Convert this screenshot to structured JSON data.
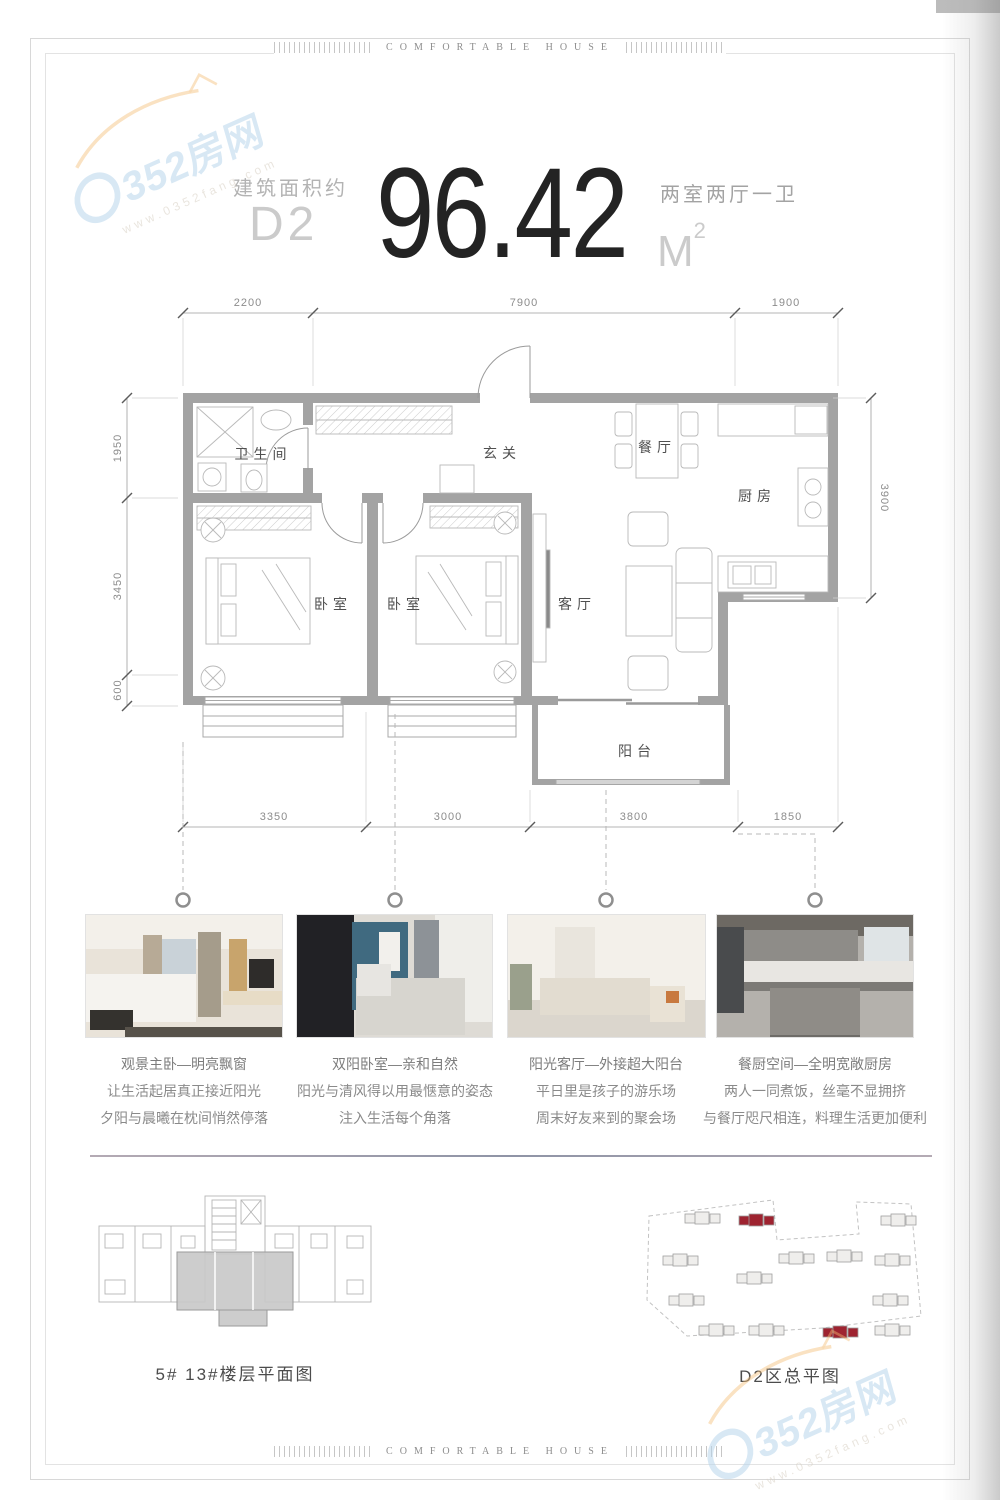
{
  "page": {
    "border_text": "COMFORTABLE HOUSE"
  },
  "watermark": {
    "brand": "0352房网",
    "brand_tail": "352房网",
    "url": "www.0352fang.com"
  },
  "header": {
    "area_label": "建筑面积约",
    "unit_code": "D2",
    "area_value": "96.42",
    "area_unit": "M",
    "area_unit_sup": "2",
    "layout_label": "两室两厅一卫"
  },
  "floor_plan": {
    "rooms": [
      "卫生间",
      "玄关",
      "餐厅",
      "厨房",
      "卧室",
      "卧室",
      "客厅",
      "阳台"
    ],
    "dimensions": {
      "top": [
        "2200",
        "7900",
        "1900"
      ],
      "bottom": [
        "3350",
        "3000",
        "3800",
        "1850"
      ],
      "left": [
        "1950",
        "3450",
        "600"
      ],
      "right": [
        "3900"
      ]
    },
    "wall_color": "#a3a3a3"
  },
  "features": [
    {
      "photo": "master-bedroom",
      "title": "观景主卧—明亮飘窗",
      "line2": "让生活起居真正接近阳光",
      "line3": "夕阳与晨曦在枕间悄然停落"
    },
    {
      "photo": "second-bedroom",
      "title": "双阳卧室—亲和自然",
      "line2": "阳光与清风得以用最惬意的姿态",
      "line3": "注入生活每个角落"
    },
    {
      "photo": "living-room",
      "title": "阳光客厅—外接超大阳台",
      "line2": "平日里是孩子的游乐场",
      "line3": "周末好友来到的聚会场"
    },
    {
      "photo": "kitchen",
      "title": "餐厨空间—全明宽敞厨房",
      "line2": "两人一同煮饭，丝毫不显拥挤",
      "line3": "与餐厅咫尺相连，料理生活更加便利"
    }
  ],
  "footer": {
    "floor_diagram_label": "5# 13#楼层平面图",
    "site_plan_label": "D2区总平图"
  },
  "colors": {
    "highlight_building": "#9e2330",
    "watermark_blue": "#b9d6ec",
    "watermark_orange": "#f3bc74"
  }
}
